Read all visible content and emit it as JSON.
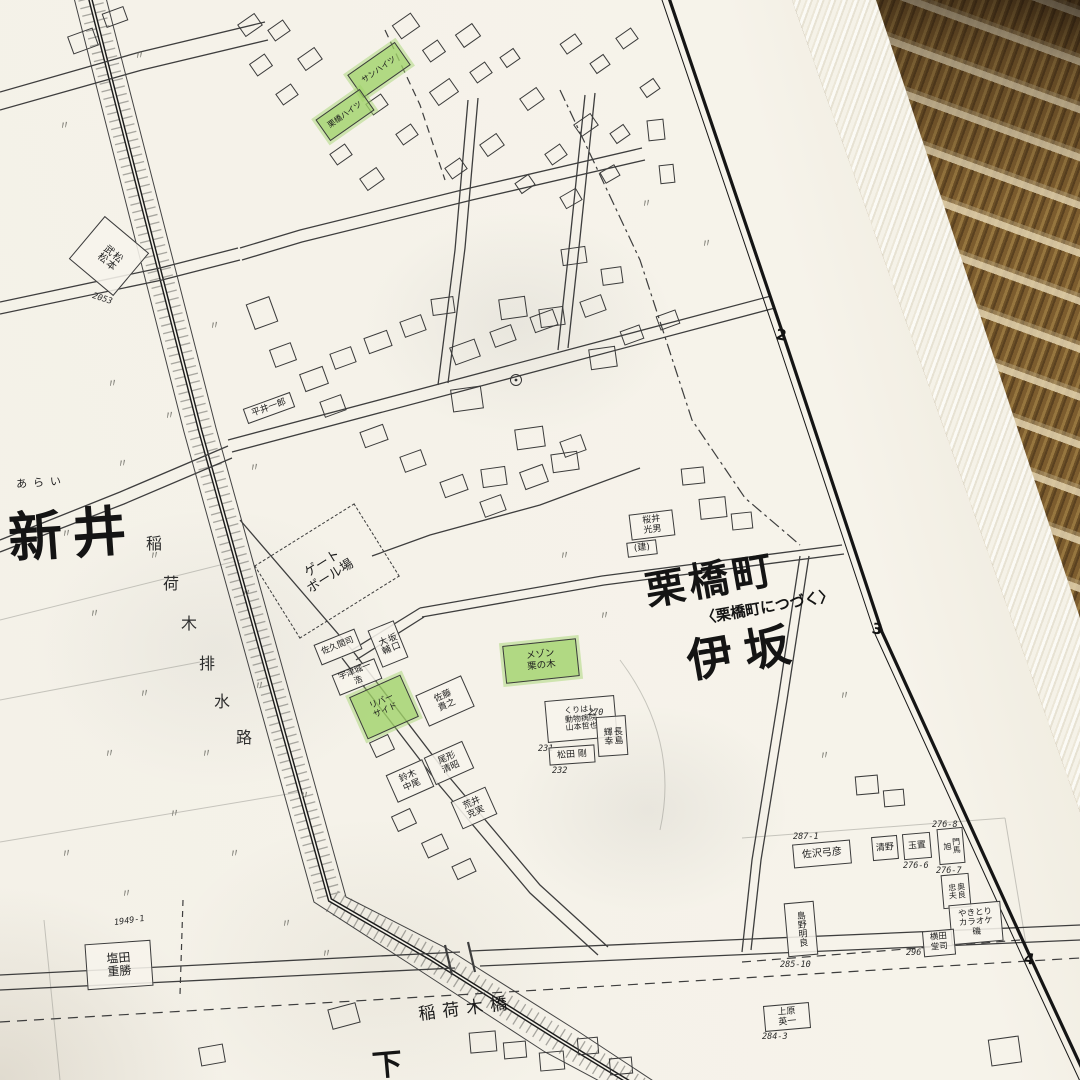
{
  "colors": {
    "highlight": "#a8d878",
    "paper": "#f4f1e8",
    "mat": "#8a6a3a",
    "ink": "#3b3b3b"
  },
  "grid_labels": {
    "row2": "2",
    "row3": "3",
    "row4": "4"
  },
  "areas": {
    "arai": {
      "furigana": "あらい",
      "label": "新井"
    },
    "kurihashi": {
      "label": "栗橋町",
      "note": "〈栗橋町につづく〉"
    },
    "isaka": {
      "label": "伊坂"
    },
    "shimo": {
      "label": "下"
    }
  },
  "features": {
    "canal": {
      "c0": "稲",
      "c1": "荷",
      "c2": "木",
      "c3": "排",
      "c4": "水",
      "c5": "路"
    },
    "bridge": {
      "label": "稲荷木橋"
    },
    "gateball": {
      "label": "ゲート\nボール場"
    }
  },
  "buildings": [
    {
      "name": "松本\n武松",
      "lot": "2053"
    },
    {
      "name": "塩田\n重勝",
      "lot": "1949-1"
    },
    {
      "name": "平井一郎"
    },
    {
      "name": "佐久間司"
    },
    {
      "name": "坂口\n大輔"
    },
    {
      "name": "宇津城一浩"
    },
    {
      "name": "リバー\nサイド"
    },
    {
      "name": "佐藤\n貴之"
    },
    {
      "name": "鈴木\n中尾"
    },
    {
      "name": "尾形\n清昭"
    },
    {
      "name": "荒井\n克実"
    },
    {
      "name": "メゾン\n栗の木"
    },
    {
      "name": "くりはし\n動物病院\n山本哲也",
      "lot": "231"
    },
    {
      "name": "松田 剛",
      "lot": "232"
    },
    {
      "name": "長島\n輝幸",
      "lot": "270"
    },
    {
      "name": "桜井\n光男"
    },
    {
      "name": "(建)"
    },
    {
      "name": "佐沢弓彦",
      "lot": "287-1"
    },
    {
      "name": "清野"
    },
    {
      "name": "玉置",
      "lot": "276-6"
    },
    {
      "name": "門馬\n旭",
      "lot": "276-8"
    },
    {
      "name": "奥良\n忠夫",
      "lot": "276-7"
    },
    {
      "name": "やきとり\nカラオケ\n磯"
    },
    {
      "name": "横田\n堂司",
      "lot": "296"
    },
    {
      "name": "島野明良",
      "lot": "285-10"
    },
    {
      "name": "上原\n英一",
      "lot": "284-3"
    },
    {
      "name": "サンハイツ"
    },
    {
      "name": "栗橋ハイツ"
    }
  ]
}
